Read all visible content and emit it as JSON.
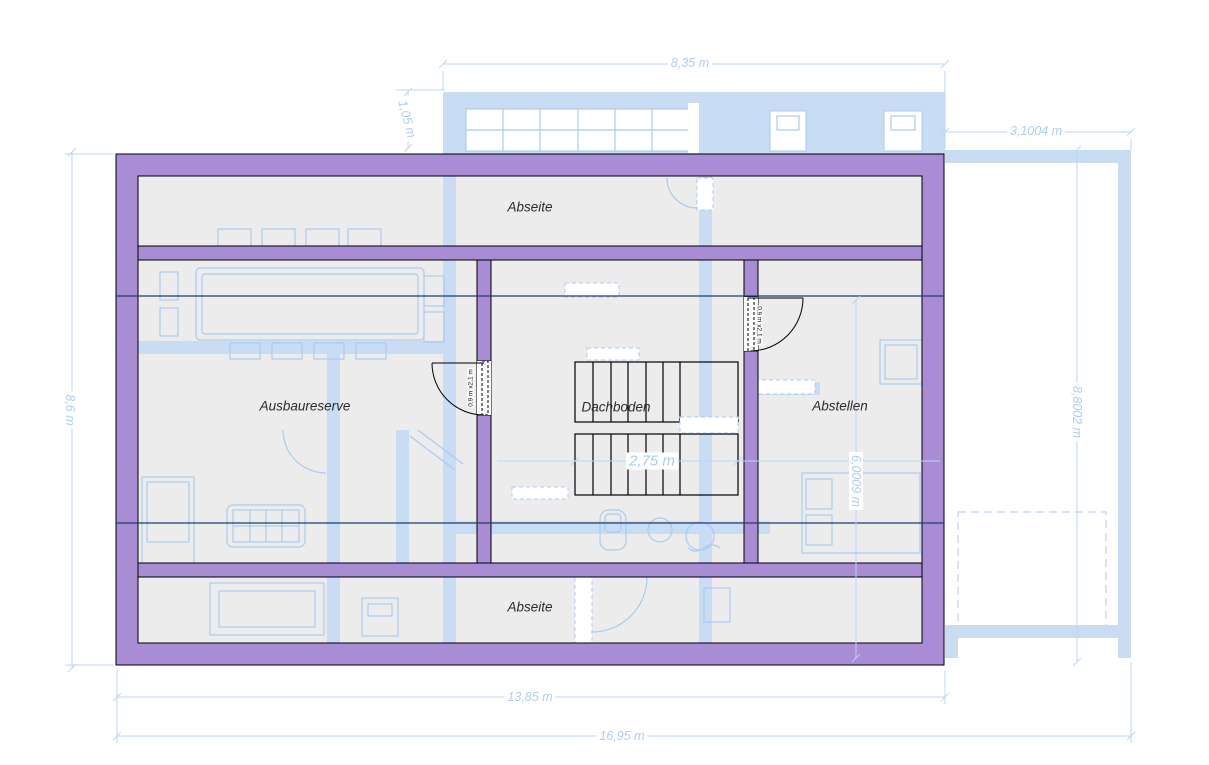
{
  "rooms": {
    "abseite_top": "Abseite",
    "ausbaureserve": "Ausbaureserve",
    "dachboden": "Dachboden",
    "abstellen": "Abstellen",
    "abseite_bottom": "Abseite"
  },
  "dimensions": {
    "top_width": "8,35 m",
    "gable_offset": "1,05 m",
    "right_extension_width": "3,1004 m",
    "left_height": "8,6 m",
    "right_height": "8,8002 m",
    "storage_height": "6,0009 m",
    "stair_width": "2,75 m",
    "attic_width": "13,85 m",
    "total_width": "16,95 m"
  },
  "doors": {
    "door_left": "0,9 m x2,1 m",
    "door_right": "0,9 m x2,1 m"
  },
  "colors": {
    "wall": "#a88dd5",
    "room": "#ececec",
    "uband": "#c8dcf4",
    "ufurn": "#a9cbf0",
    "navy": "#1d3c6e",
    "dimline": "#bcd6f3",
    "dimtext": "#b0cdf0",
    "labeltext": "#2b2b2b"
  }
}
